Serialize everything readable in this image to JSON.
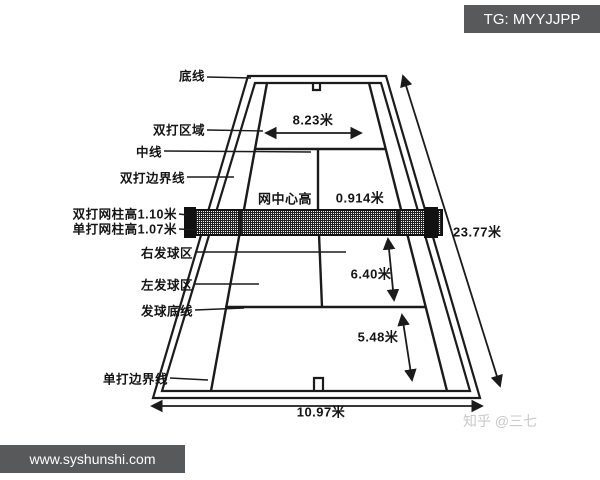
{
  "header": {
    "tg_badge": "TG: MYYJJPP"
  },
  "footer": {
    "site_badge": "www.syshunshi.com",
    "watermark": "知乎 @三七"
  },
  "colors": {
    "badge_bg": "#57595b",
    "line": "#1b1b1b",
    "watermark": "#c9c9c9"
  },
  "court": {
    "labels": {
      "baseline": "底线",
      "doubles_area": "双打区域",
      "center_line": "中线",
      "doubles_sideline": "双打边界线",
      "doubles_net_post_height": "双打网柱高1.10米",
      "singles_net_post_height": "单打网柱高1.07米",
      "right_service_box": "右发球区",
      "left_service_box": "左发球区",
      "service_baseline": "发球底线",
      "singles_sideline": "单打边界线",
      "net_center_height": "网中心高"
    },
    "dimensions": {
      "singles_width": "8.23米",
      "net_center_height": "0.914米",
      "net_to_service_line": "6.40米",
      "service_line_to_baseline": "5.48米",
      "doubles_width": "10.97米",
      "court_length": "23.77米"
    }
  }
}
